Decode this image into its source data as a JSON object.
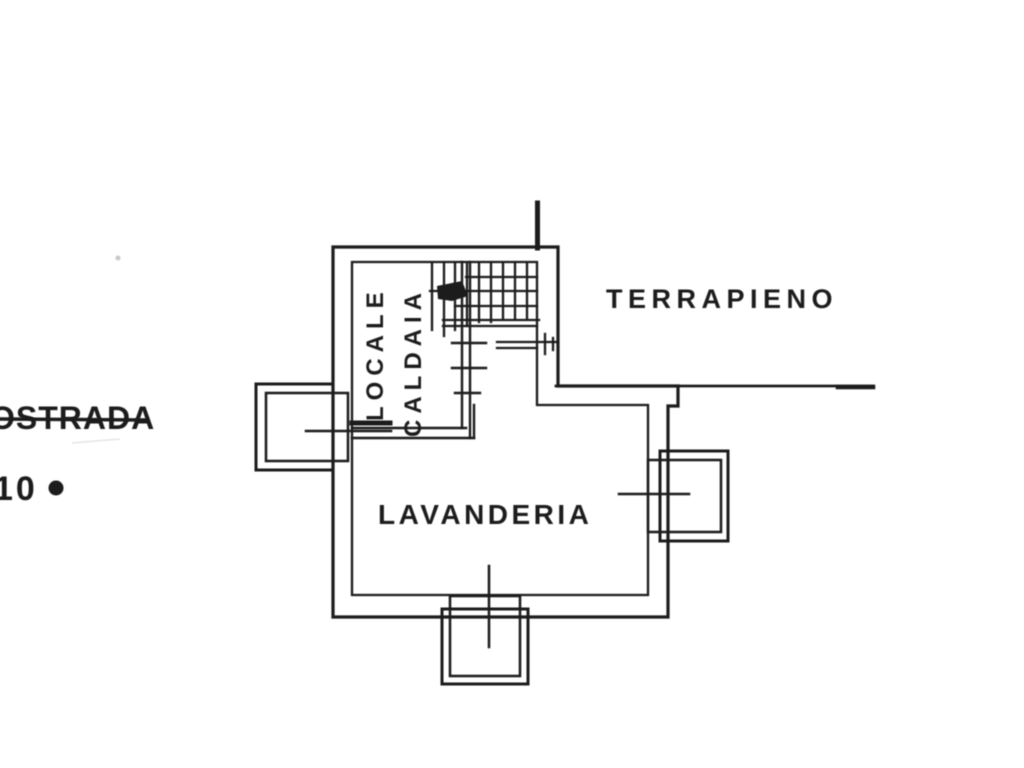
{
  "drawing": {
    "type": "scanned-architectural-floor-plan",
    "labels": {
      "terrapieno": "TERRAPIENO",
      "lavanderia": "LAVANDERIA",
      "boiler_room_line1": "LOCALE",
      "boiler_room_line2": "CALDAIA",
      "road_text": "OSTRADA",
      "road_number": "10",
      "road_marker": "•"
    },
    "colors": {
      "ink": "#1c1c1c",
      "paper": "#ffffff",
      "faint_artifact": "#c9c9c9"
    }
  }
}
